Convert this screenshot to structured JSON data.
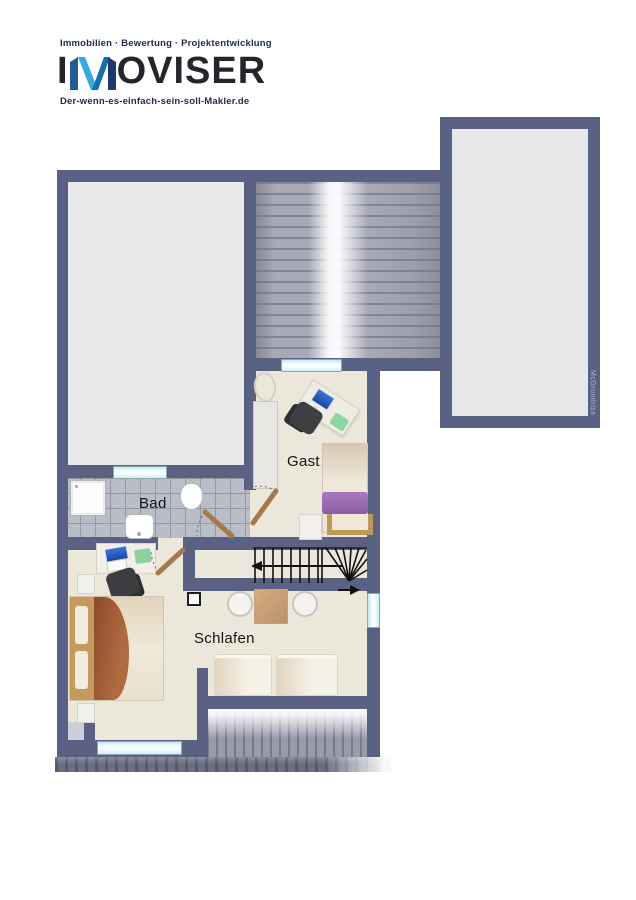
{
  "brand": {
    "tagline": "Immobilien · Bewertung · Projektentwicklung",
    "name_prefix": "I",
    "name_suffix": "OVISER",
    "domain": "Der-wenn-es-einfach-sein-soll-Makler.de",
    "colors": {
      "navy_text": "#1d2b50",
      "logo_text": "#25252d",
      "m_dark": "#1c3a6b",
      "m_light": "#35aadf",
      "m_mid": "#1470ab"
    }
  },
  "floorplan": {
    "labels": {
      "guest": "Gast",
      "bath": "Bad",
      "bedroom": "Schlafen"
    },
    "watermark": "McGrundriss",
    "colors": {
      "wall": "#5a6182",
      "floor": "#ece7db",
      "attic_room": "#e9e9ea",
      "tiles": "#b9bdc5",
      "window": "#cdeef6",
      "door": "#a5794c",
      "stairs_line": "#111111",
      "blanket_bed": "#9c5a34",
      "blanket_guest": "#9a67ae"
    }
  }
}
